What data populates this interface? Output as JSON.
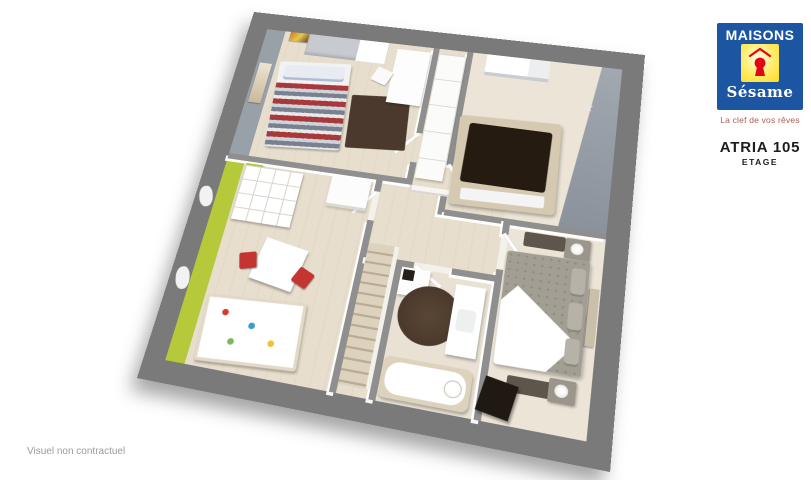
{
  "branding": {
    "logo_line1": "MAISONS",
    "logo_line2": "Sésame",
    "tagline": "La clef de vos rêves"
  },
  "plan_info": {
    "title": "ATRIA 105",
    "subtitle": "ETAGE"
  },
  "footer": {
    "disclaimer": "Visuel non contractuel"
  },
  "colors": {
    "brandBlue": "#1c56a2",
    "brandYellow": "#fbdb26",
    "brandRed": "#e10613",
    "taglineRed": "#ad5a50",
    "titleBlack": "#1d1d1d",
    "disclaimerGray": "#9b9b9b",
    "outerWall": "#7a7a7a",
    "innerWall": "#8f8f8f",
    "floorWood": "#e7decd",
    "floorCarpet": "#ece4d6",
    "floorBath": "#e9e1d4",
    "accentLime": "#b5c93b",
    "accentGrayWall": "#98a1a7",
    "rugBrown": "#4a392c",
    "bedDark": "#251b11",
    "chairRed": "#c43430",
    "stairWood": "#ddd2bd"
  }
}
